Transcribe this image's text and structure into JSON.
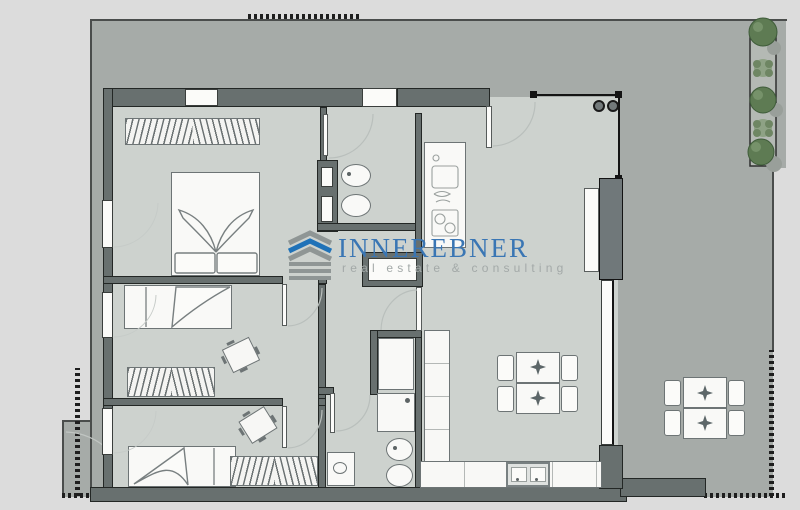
{
  "logo": {
    "brand": "INNEREBNER",
    "tagline": "real estate & consulting",
    "brand_color": "#3a76b4",
    "tagline_color": "#a3a9a8",
    "icon_blue": "#1f72b8",
    "icon_gray": "#8f9695"
  },
  "colors": {
    "page_background": "#dcdcdc",
    "garden": "#a6aba8",
    "interior_floor": "#cdd2ce",
    "wall": "#68706f",
    "furniture_white": "#f9f9f7",
    "plant_dark_green": "#5e7b53",
    "plant_light_green": "#8ea285",
    "boundary_line": "#4a4d4c"
  }
}
